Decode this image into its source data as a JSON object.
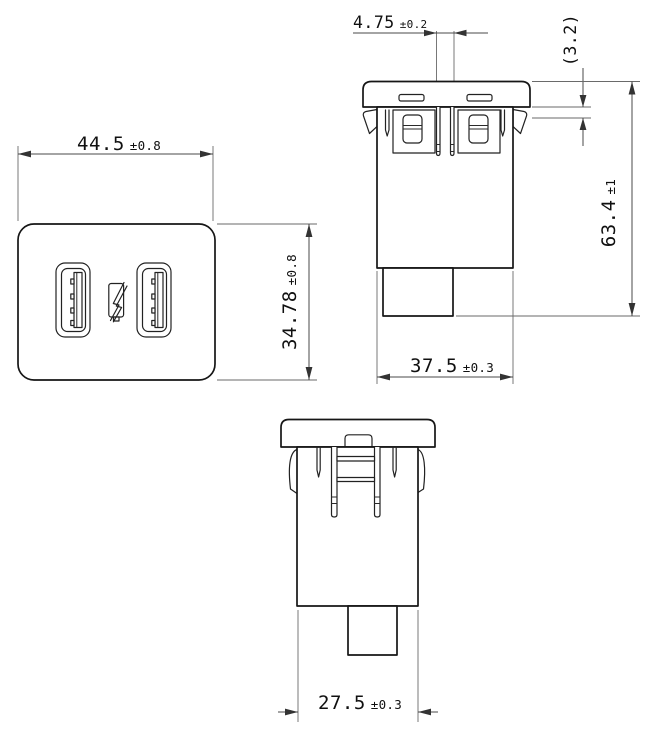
{
  "dims": {
    "front_width": {
      "value": "44.5",
      "tol": "±0.8"
    },
    "front_height": {
      "value": "34.78",
      "tol": "±0.8"
    },
    "pin_spacing": {
      "value": "4.75",
      "tol": "±0.2"
    },
    "flange_ref": {
      "value": "(3.2)",
      "tol": ""
    },
    "total_height": {
      "value": "63.4",
      "tol": "±1"
    },
    "body_depth": {
      "value": "37.5",
      "tol": "±0.3"
    },
    "body_width": {
      "value": "27.5",
      "tol": "±0.3"
    }
  },
  "icons": {
    "charging_symbol": "lightning-bolt"
  },
  "accent_colors": {
    "line": "#161616",
    "dimension": "#4a4a4a",
    "background": "#ffffff"
  }
}
